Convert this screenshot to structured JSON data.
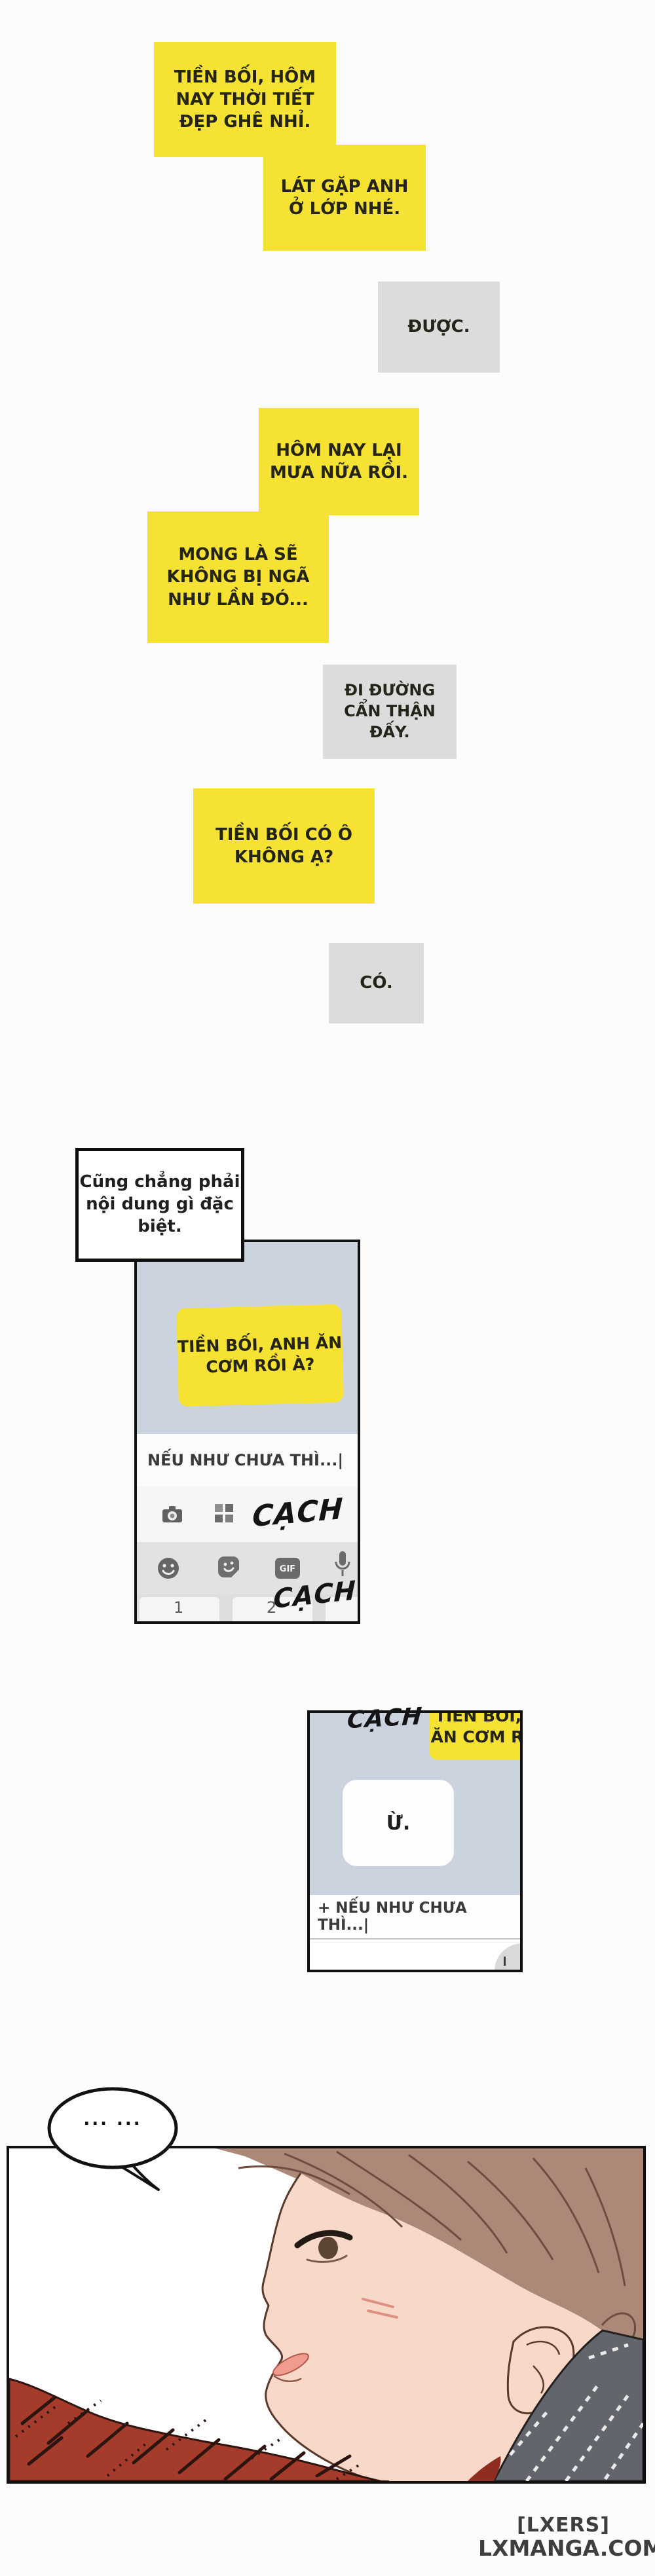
{
  "page": {
    "background": "#fcfcfc"
  },
  "colors": {
    "bubble_yellow": "#f5e233",
    "bubble_gray": "#dcdcdc",
    "phone_chat_background": "#cbd3df",
    "panel_border": "#101010"
  },
  "chat_bubbles": [
    {
      "from": "junior",
      "text": "TIỀN BỐI, HÔM NAY THỜI TIẾT ĐẸP GHÊ NHỈ."
    },
    {
      "from": "junior",
      "text": "LÁT GẶP ANH Ở LỚP NHÉ."
    },
    {
      "from": "senior",
      "text": "ĐƯỢC."
    },
    {
      "from": "junior",
      "text": "HÔM NAY LẠI MƯA NỮA RỒI."
    },
    {
      "from": "junior",
      "text": "MONG LÀ SẼ KHÔNG BỊ NGÃ NHƯ LẦN ĐÓ..."
    },
    {
      "from": "senior",
      "text": "ĐI ĐƯỜNG CẨN THẬN ĐẤY."
    },
    {
      "from": "junior",
      "text": "TIỀN BỐI CÓ Ô KHÔNG Ạ?"
    },
    {
      "from": "senior",
      "text": "CÓ."
    }
  ],
  "narration": {
    "text": "Cũng chẳng phải nội dung gì đặc biệt."
  },
  "phone1": {
    "message": "TIỀN BỐI, ANH ĂN CƠM RỒI À?",
    "input_text": "NẾU NHƯ CHƯA THÌ...|",
    "sfx_top": "CẠCH",
    "sfx_bottom": "CẠCH",
    "gif_label": "GIF",
    "key1": "1",
    "key2": "2",
    "icons": [
      "camera-icon",
      "grid-icon",
      "emoji-icon",
      "sticker-icon",
      "gif-icon",
      "mic-icon"
    ]
  },
  "phone2": {
    "sfx": "CẠCH",
    "partial_message_line1": "TIỀN BỐI, ANH",
    "partial_message_line2": "ĂN CƠM RỒI À?",
    "reply": "Ừ.",
    "input_text": "+ NẾU NHƯ CHƯA THÌ...|"
  },
  "art": {
    "speech": "... ..."
  },
  "watermark": {
    "line1": "[LXERS]",
    "line2": "LXMANGA.COM"
  }
}
